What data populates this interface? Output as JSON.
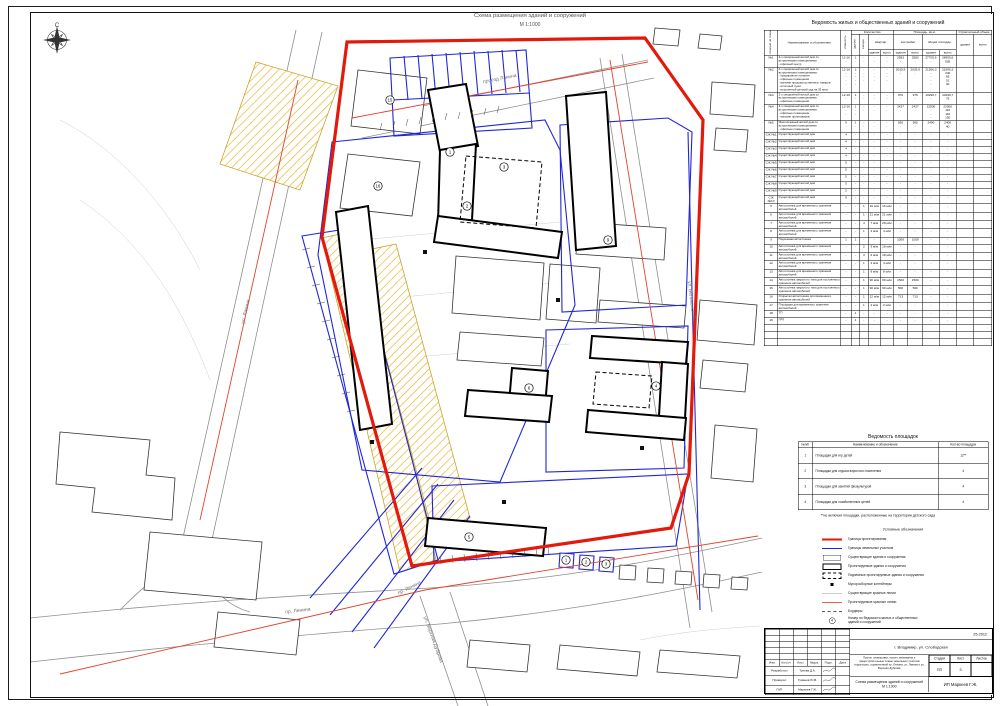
{
  "sheet": {
    "drawing_title": "Схема размещения зданий и сооружений",
    "drawing_scale": "М 1:1000",
    "compass_north": "С"
  },
  "map": {
    "street_labels": [
      {
        "text": "проезд Лакина",
        "x": 500,
        "y": 80,
        "rot": -11
      },
      {
        "text": "ул. Лакина",
        "x": 247,
        "y": 312,
        "rot": -77
      },
      {
        "text": "пр. Ленина",
        "x": 410,
        "y": 589,
        "rot": -26
      },
      {
        "text": "пр. Ленина",
        "x": 298,
        "y": 612,
        "rot": -7
      },
      {
        "text": "ул. Верхняя Дуброва",
        "x": 432,
        "y": 640,
        "rot": 70
      },
      {
        "text": "ул. Белоконской",
        "x": 690,
        "y": 300,
        "rot": 83
      }
    ],
    "markers": [
      {
        "n": "1",
        "x": 450,
        "y": 152
      },
      {
        "n": "2",
        "x": 467,
        "y": 206
      },
      {
        "n": "3",
        "x": 504,
        "y": 167
      },
      {
        "n": "4",
        "x": 656,
        "y": 386
      },
      {
        "n": "5",
        "x": 469,
        "y": 537
      },
      {
        "n": "6",
        "x": 529,
        "y": 388
      },
      {
        "n": "9",
        "x": 608,
        "y": 240
      },
      {
        "n": "15",
        "x": 390,
        "y": 100
      },
      {
        "n": "16",
        "x": 378,
        "y": 186
      },
      {
        "n": "1",
        "x": 566,
        "y": 560
      },
      {
        "n": "2",
        "x": 586,
        "y": 562
      },
      {
        "n": "3",
        "x": 606,
        "y": 564
      }
    ]
  },
  "buildings_table": {
    "title": "Ведомость жилых и общественных зданий и сооружений",
    "headers": {
      "pos": "Позиция на плане",
      "name": "Наименование и обозначение",
      "floors": "Этажность",
      "count": "Количество",
      "bld": "Зданий",
      "sec": "Секций",
      "apt": "квартир",
      "area": "Площадь, кв.м.",
      "built": "застройки",
      "total": "общая площадь",
      "volume": "Строительный объем",
      "unit_b": "здания",
      "unit_t": "всего"
    },
    "rows": [
      [
        "№1",
        "4-х секционный жилой дом со\nвстроенными помещениями\n- офисный центр",
        "12-16\n-",
        "1\n-",
        "-\n-",
        "-\n-",
        "-\n-",
        "2583\n-",
        "2583\n-",
        "27705,6\n-",
        "28955,6\n505",
        "",
        ""
      ],
      [
        "№2",
        "4-х секционный жилой дом со\nвстроенными помещениями:\n- предприятие питания\n- офисные помещения\n- магазин продовольственных товаров\n- аптечный пункт\n- встроенный детский сад на 35 мест",
        "12-16\n-\n-\n-\n-",
        "1\n-\n-\n-\n-",
        "-\n-\n-\n-",
        "-\n-\n-\n-",
        "-\n-\n-\n-",
        "2035,9\n-",
        "2035,9\n-",
        "21506,3\n-\n-\n-\n-",
        "21506,3\n240\n65\n51\n90",
        "",
        ""
      ],
      [
        "№3",
        "2-х секционный жилой дом со\nвстроенными помещениями\n- офисные помещения",
        "12-16\n-",
        "1\n-",
        "-\n-",
        "-\n-",
        "-\n-",
        "976\n-",
        "976\n-",
        "10296,7\n-",
        "10296,7\n75",
        "",
        ""
      ],
      [
        "№4",
        "3-х секционный жилой дом со\nвстроенными помещениями:\n- офисные помещения\n- магазин промтоваров",
        "12-16\n-\n-",
        "1\n-\n-",
        "-\n-",
        "-\n-",
        "-\n-",
        "2427\n-",
        "2427\n-",
        "22500\n-\n-\n-",
        "22500\n110\n110\n150",
        "",
        ""
      ],
      [
        "№5",
        "Многоэтажный жилой дом со\nвстроенными помещениями\n- офисные помещения",
        "9\n-",
        "1\n-",
        "-\n-",
        "-\n-",
        "-\n-",
        "565\n-",
        "565\n-",
        "2400\n-",
        "2400\n40",
        "",
        ""
      ],
      [
        "СЖ №1",
        "Существующий жилой дом",
        "4",
        "-",
        "-",
        "-",
        "-",
        "-",
        "-",
        "-",
        "-",
        "",
        ""
      ],
      [
        "СЖ №2",
        "Существующий жилой дом",
        "4",
        "-",
        "-",
        "-",
        "-",
        "-",
        "-",
        "-",
        "-",
        "",
        ""
      ],
      [
        "СЖ №3",
        "Существующий жилой дом",
        "4",
        "-",
        "-",
        "-",
        "-",
        "-",
        "-",
        "-",
        "-",
        "",
        ""
      ],
      [
        "СЖ №4",
        "Существующий жилой дом",
        "4",
        "-",
        "-",
        "-",
        "-",
        "-",
        "-",
        "-",
        "-",
        "",
        ""
      ],
      [
        "СЖ №5",
        "Существующий жилой дом",
        "5",
        "-",
        "-",
        "-",
        "-",
        "-",
        "-",
        "-",
        "-",
        "",
        ""
      ],
      [
        "СЖ №6",
        "Существующий жилой дом",
        "5",
        "-",
        "-",
        "-",
        "-",
        "-",
        "-",
        "-",
        "-",
        "",
        ""
      ],
      [
        "СЖ №7",
        "Существующий жилой дом",
        "5",
        "-",
        "-",
        "-",
        "-",
        "-",
        "-",
        "-",
        "-",
        "",
        ""
      ],
      [
        "СЖ №8",
        "Существующий жилой дом",
        "5",
        "-",
        "-",
        "-",
        "-",
        "-",
        "-",
        "-",
        "-",
        "",
        ""
      ],
      [
        "СЖ №9",
        "Существующий жилой дом",
        "2",
        "-",
        "-",
        "-",
        "-",
        "-",
        "-",
        "-",
        "-",
        "",
        ""
      ],
      [
        "СЖ №10",
        "Существующий жилой дом",
        "9",
        "-",
        "-",
        "-",
        "-",
        "-",
        "-",
        "-",
        "-",
        "",
        ""
      ],
      [
        "5",
        "Автостоянка для временного хранения автомобилей",
        "-",
        "-",
        "1",
        "16 м/м",
        "16 м/м",
        "-",
        "-",
        "-",
        "-",
        "",
        ""
      ],
      [
        "6",
        "Автостоянка для временного хранения автомобилей",
        "-",
        "-",
        "1",
        "21 м/м",
        "21 м/м",
        "-",
        "-",
        "-",
        "-",
        "",
        ""
      ],
      [
        "7",
        "Автостоянка для временного хранения автомобилей",
        "-",
        "-",
        "4",
        "7 м/м",
        "28 м/м",
        "-",
        "-",
        "-",
        "-",
        "",
        ""
      ],
      [
        "8",
        "Автостоянка для временного хранения автомобилей",
        "-",
        "-",
        "1",
        "4 м/м",
        "4 м/м",
        "-",
        "-",
        "-",
        "-",
        "",
        ""
      ],
      [
        "9",
        "Подземная автостоянка",
        "1",
        "1",
        "-",
        "-",
        "-",
        "1059",
        "1059",
        "-",
        "-",
        "",
        ""
      ],
      [
        "10",
        "Автостоянка для временного хранения автомобилей",
        "-",
        "-",
        "2",
        "9 м/м",
        "18 м/м",
        "-",
        "-",
        "-",
        "-",
        "",
        ""
      ],
      [
        "11",
        "Автостоянка для временного хранения автомобилей",
        "-",
        "-",
        "3",
        "6 м/м",
        "18 м/м",
        "-",
        "-",
        "-",
        "-",
        "",
        ""
      ],
      [
        "12",
        "Автостоянка для временного хранения автомобилей",
        "-",
        "-",
        "1",
        "4 м/м",
        "4 м/м",
        "-",
        "-",
        "-",
        "-",
        "",
        ""
      ],
      [
        "13",
        "Автостоянка для временного хранения автомобилей",
        "-",
        "-",
        "1",
        "8 м/м",
        "8 м/м",
        "-",
        "-",
        "-",
        "-",
        "",
        ""
      ],
      [
        "14",
        "Автостоянка закрытого типа для постоянного хранения автомобилей",
        "-",
        "-",
        "1",
        "90 м/м",
        "90 м/м",
        "1500",
        "1500",
        "-",
        "-",
        "",
        ""
      ],
      [
        "15",
        "Автостоянка закрытого типа для постоянного хранения автомобилей",
        "-",
        "-",
        "1",
        "90 м/м",
        "90 м/м",
        "500",
        "500",
        "-",
        "-",
        "",
        ""
      ],
      [
        "16",
        "Открытая автостоянка для временного хранения автомобилей",
        "-",
        "-",
        "1",
        "12 м/м",
        "12 м/м",
        "713",
        "713",
        "-",
        "-",
        "",
        ""
      ],
      [
        "17",
        "Площадка для временного хранения автомобилей",
        "-",
        "-",
        "1",
        "2 м/м",
        "2 м/м",
        "-",
        "-",
        "-",
        "-",
        "",
        ""
      ],
      [
        "18",
        "ТП",
        "-",
        "1",
        "-",
        "-",
        "-",
        "-",
        "-",
        "-",
        "-",
        "",
        ""
      ],
      [
        "19",
        "ГРП",
        "-",
        "1",
        "-",
        "-",
        "-",
        "-",
        "-",
        "-",
        "-",
        "",
        ""
      ]
    ]
  },
  "platforms_table": {
    "title": "Ведомость площадок",
    "headers": [
      "№п/п",
      "Наименование и обозначение",
      "Кол-во площадок"
    ],
    "rows": [
      [
        "1",
        "Площадки для игр детей",
        "12**"
      ],
      [
        "2",
        "Площадки для отдыха взрослого населения",
        "4"
      ],
      [
        "3",
        "Площадки для занятий физкультурой",
        "4"
      ],
      [
        "4",
        "Площадки для хозяйственных целей",
        "4"
      ]
    ]
  },
  "footnote": "**не включая площадки, расположенные на территории детского сада",
  "legend": {
    "title": "Условные обозначения",
    "circle_char": "4",
    "items": [
      {
        "sym": "red-thick",
        "label": "Граница проектирования"
      },
      {
        "sym": "blue-line",
        "label": "Границы земельных участков"
      },
      {
        "sym": "rect-thin",
        "label": "Существующие здания и сооружения"
      },
      {
        "sym": "rect-thick",
        "label": "Проектируемые здания и сооружения"
      },
      {
        "sym": "rect-dashed",
        "label": "Подземные проектируемые здания и сооружения"
      },
      {
        "sym": "square",
        "label": "Мусоросборные контейнеры"
      },
      {
        "sym": "gray-line",
        "label": "Существующие красные линии"
      },
      {
        "sym": "pink-line",
        "label": "Проектируемые красные линии"
      },
      {
        "sym": "dash-line",
        "label": "Бордюры"
      },
      {
        "sym": "circle",
        "label": "Номер по Ведомости жилых и общественных\nзданий и сооружений"
      }
    ]
  },
  "title_block": {
    "project_no": "25-2012",
    "location": "г. Владимир, ул. Слободская",
    "description": "Проект планировки, проект межевания и градостроительные планы земельных участков территории, ограниченной пр. Ленина, ул. Лакина и ул. Верхняя Дуброва",
    "doc_title": "Схема размещения зданий и сооружений\nМ 1:1000",
    "org": "ИП Маркеев Г.Ж.",
    "stage_label": "Стадия",
    "sheet_label": "Лист",
    "sheets_label": "Листов",
    "stage": "ПП",
    "sheet_no": "3",
    "sheets_total": "",
    "head_cols": [
      "Изм.",
      "Кол.уч.",
      "Лист",
      "№док.",
      "Подп.",
      "Дата"
    ],
    "roles": [
      {
        "role": "Разработал",
        "name": "Тунева Д.А."
      },
      {
        "role": "Проверил",
        "name": "Гуманов Ю.В."
      },
      {
        "role": "ГАП",
        "name": "Маркеев Г.Ж."
      }
    ]
  }
}
